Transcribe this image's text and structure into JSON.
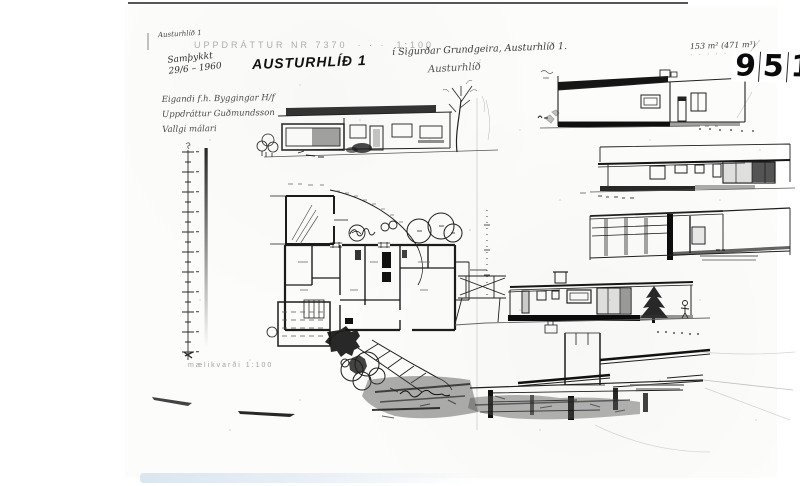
{
  "document": {
    "corner_note": "Austurhlíð 1",
    "stamp": {
      "text": "UPPDRÁTTUR NR 7370",
      "dots": "· · ·",
      "scale": "1:100"
    },
    "approval": {
      "line1": "Samþykkt",
      "line2": "29/6 – 1960"
    },
    "title": "AUSTURHLÍÐ 1",
    "location_note": "í Sigurðar Grundgeira, Austurhlíð 1.",
    "location_note2": "Austurhlíð",
    "owner_notes": [
      "Eigandi f.h. Byggingar H/f",
      "Uppdráttur Guðmundsson",
      "Vallgi málari"
    ],
    "area_note": "153 m²   (471 m³)",
    "area_note2": "· · · · ·",
    "plate_digits": [
      "9",
      "5",
      "1"
    ],
    "scale_note": "mælikvarði 1:100",
    "colors": {
      "ink": "#1c1c1c",
      "paper": "#fcfcfb",
      "faint_stamp": "#8a8a8a",
      "scan_band": "#d7e3ee"
    }
  }
}
